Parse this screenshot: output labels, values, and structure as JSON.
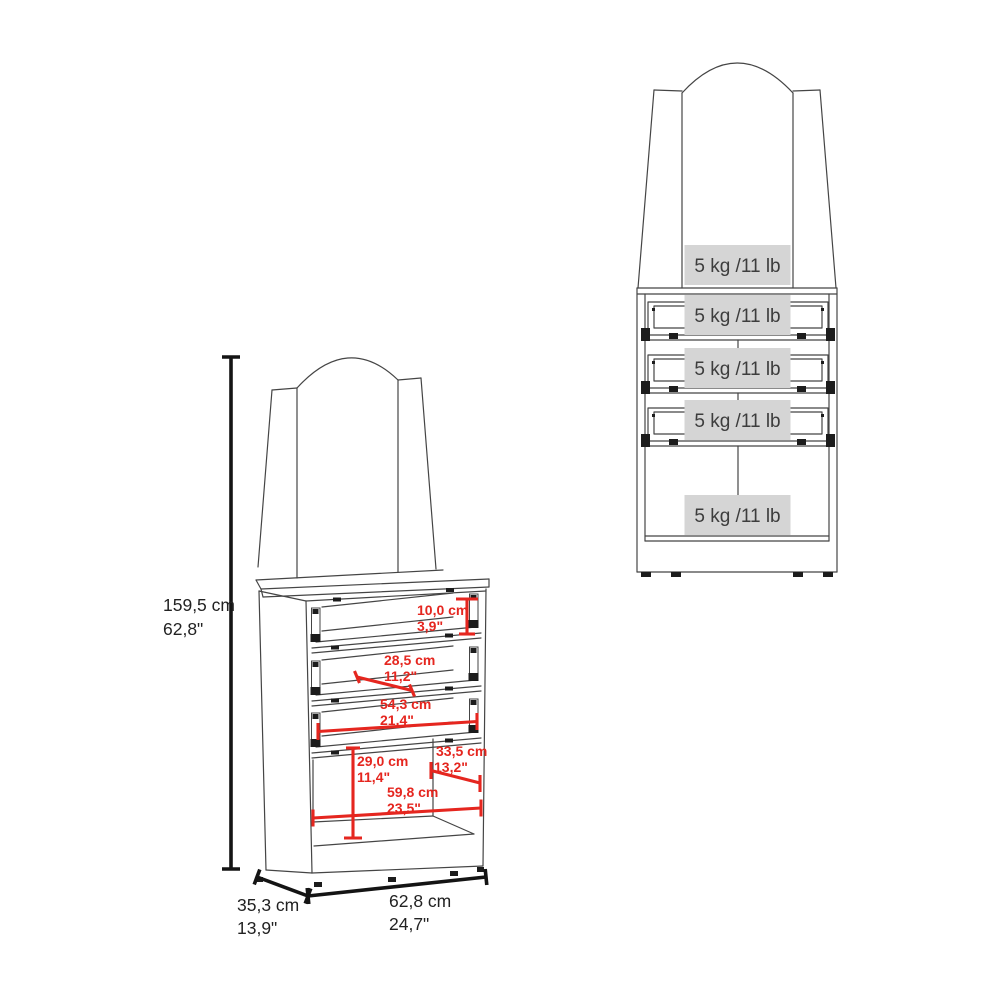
{
  "page": {
    "description": "Furniture assembly-style dimension and weight-capacity diagram of a dressing table with mirror hutch, 3 drawers and open lower cabinet",
    "background": "#ffffff"
  },
  "colors": {
    "line_color": "#454545",
    "dim_line_color": "#141414",
    "dim_text_color": "#222222",
    "annotation_red": "#e5261f",
    "label_bg": "#d5d5d5",
    "label_text_color": "#3d3d3d",
    "hardware_color": "#1c1c1c",
    "page_bg": "#ffffff"
  },
  "left_figure": {
    "name": "dimensioned-perspective-view",
    "overall_height": {
      "cm": "159,5 cm",
      "in": "62,8\""
    },
    "overall_depth": {
      "cm": "35,3 cm",
      "in": "13,9\""
    },
    "overall_width": {
      "cm": "62,8 cm",
      "in": "24,7\""
    },
    "annotations": [
      {
        "id": "drawer-height",
        "cm": "10,0 cm",
        "in": "3,9\""
      },
      {
        "id": "drawer-depth",
        "cm": "28,5 cm",
        "in": "11,2\""
      },
      {
        "id": "drawer-width",
        "cm": "54,3 cm",
        "in": "21,4\""
      },
      {
        "id": "cubby-depth",
        "cm": "33,5 cm",
        "in": "13,2\""
      },
      {
        "id": "cubby-height",
        "cm": "29,0 cm",
        "in": "11,4\""
      },
      {
        "id": "cubby-width",
        "cm": "59,8 cm",
        "in": "23,5\""
      }
    ]
  },
  "right_figure": {
    "name": "front-capacity-view",
    "capacity_labels": [
      {
        "location": "mirror-shelf",
        "text": "5 kg /11 lb"
      },
      {
        "location": "drawer-1",
        "text": "5 kg /11 lb"
      },
      {
        "location": "drawer-2",
        "text": "5 kg /11 lb"
      },
      {
        "location": "drawer-3",
        "text": "5 kg /11 lb"
      },
      {
        "location": "lower-cabinet",
        "text": "5 kg /11 lb"
      }
    ]
  }
}
